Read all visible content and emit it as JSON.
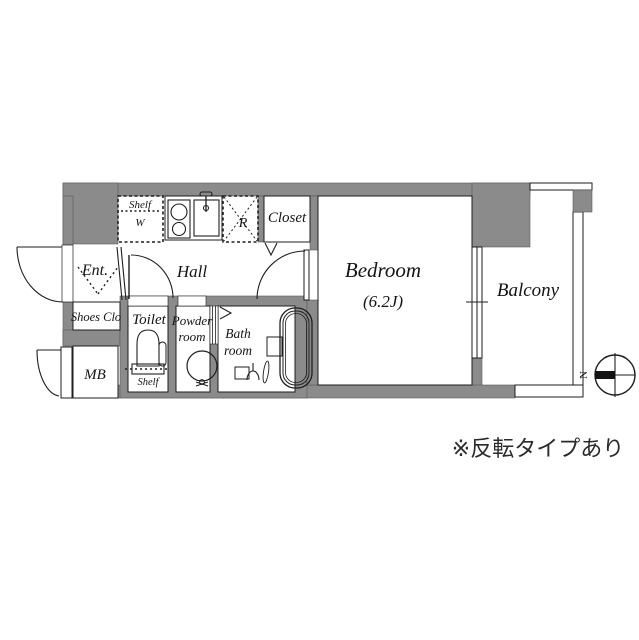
{
  "colors": {
    "wall": "#8b8b8b",
    "line": "#1e1e1e",
    "background": "#ffffff"
  },
  "rooms": {
    "bedroom": {
      "label": "Bedroom",
      "size": "(6.2J)"
    },
    "balcony": {
      "label": "Balcony"
    },
    "hall": {
      "label": "Hall"
    },
    "entrance": {
      "label": "Ent."
    },
    "shoes_closet": {
      "label": "Shoes Clo"
    },
    "meter_box": {
      "label": "MB"
    },
    "toilet": {
      "label": "Toilet",
      "shelf_label": "Shelf"
    },
    "powder_room": {
      "label_line1": "Powder",
      "label_line2": "room"
    },
    "bath_room": {
      "label_line1": "Bath",
      "label_line2": "room"
    },
    "closet": {
      "label": "Closet"
    }
  },
  "fixtures": {
    "refrigerator_space": {
      "label": "R"
    },
    "shelf_washer": {
      "label_line1": "Shelf",
      "label_line2": "W"
    }
  },
  "compass": {
    "north_label": "N"
  },
  "caption": {
    "text": "※反転タイプあり"
  }
}
